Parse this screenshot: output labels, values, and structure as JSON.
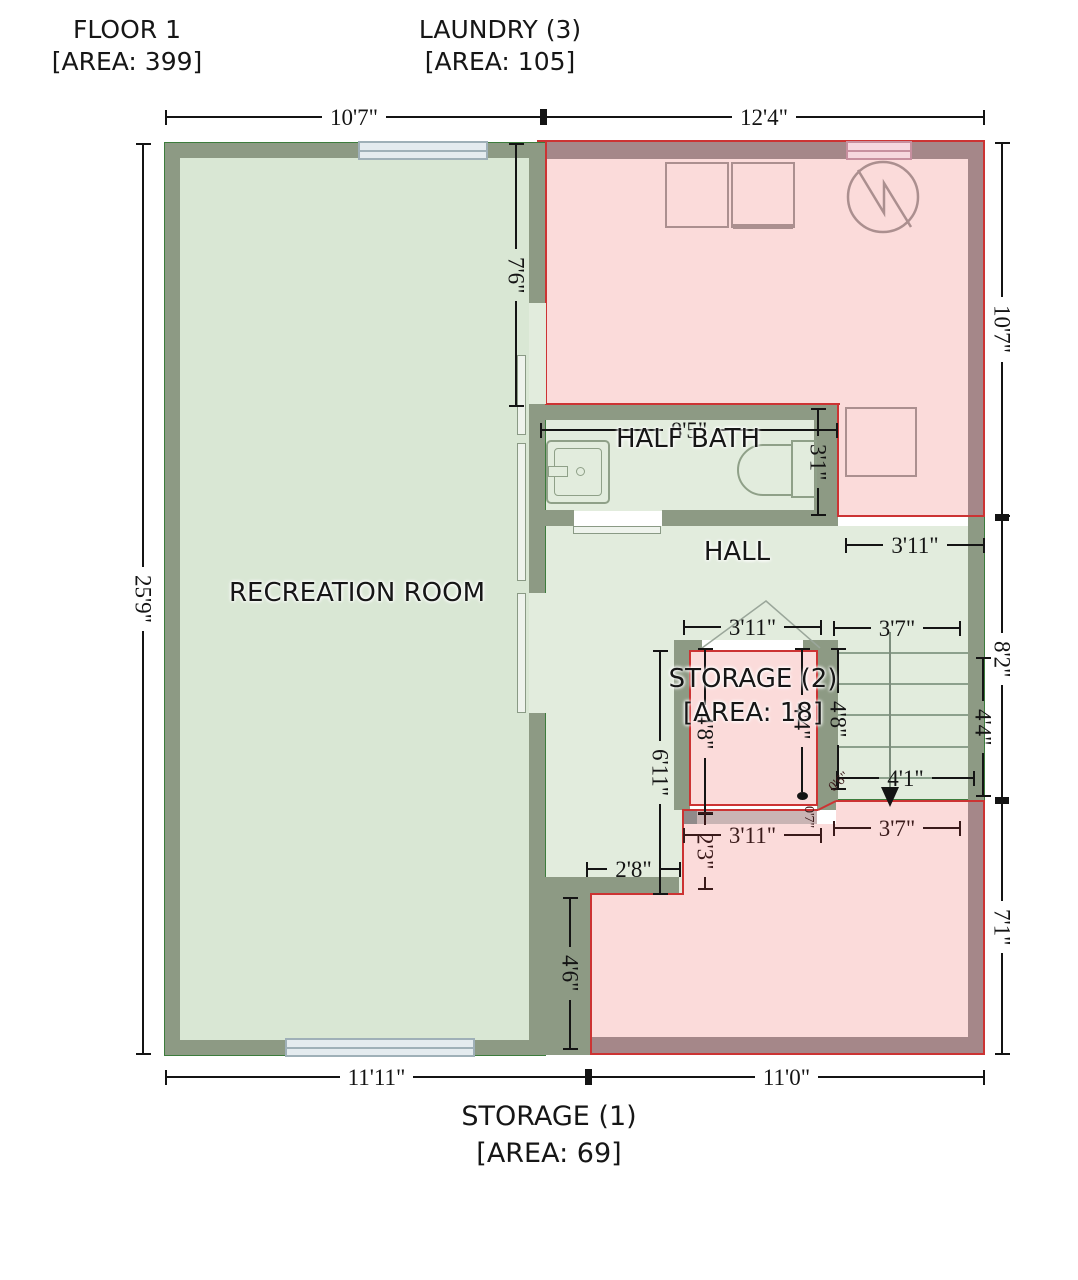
{
  "header": {
    "floor_label": "FLOOR 1",
    "floor_area": "[AREA: 399]",
    "laundry_label": "LAUNDRY (3)",
    "laundry_area": "[AREA: 105]"
  },
  "rooms": {
    "recreation": "RECREATION ROOM",
    "half_bath": "HALF BATH",
    "hall": "HALL",
    "storage2": "STORAGE (2)",
    "storage2_area": "[AREA: 18]",
    "storage1": "STORAGE (1)",
    "storage1_area": "[AREA: 69]"
  },
  "dims": {
    "top_left": "10'7\"",
    "top_right": "12'4\"",
    "left_side": "25'9\"",
    "right_top": "10'7\"",
    "right_mid": "8'2\"",
    "right_inner": "4'4\"",
    "right_bottom": "7'1\"",
    "bottom_left": "11'11\"",
    "bottom_right": "11'0\"",
    "laundry_wall": "7'6\"",
    "bath_width": "8'5\"",
    "bath_depth": "3'1\"",
    "hall_right": "3'11\"",
    "storage2_top": "3'11\"",
    "storage2_left": "4'8\"",
    "storage2_right": "4'4\"",
    "storage2_bottom": "3'11\"",
    "stairs_top": "3'7\"",
    "stairs_left": "4'8\"",
    "stairs_run": "4'1\"",
    "hall_column": "6'11\"",
    "storage1_top": "3'7\"",
    "wall_seg": "2'3\"",
    "hall_bottom": "2'8\"",
    "rec_corner": "4'6\"",
    "tiny_a": "0'6\"",
    "tiny_b": "0'7\""
  },
  "colors": {
    "green-wall": "#8d9a84",
    "green-fill": "#d9e7d4",
    "green-fill-light": "#e2ecdd",
    "green-outline": "#3c7c3c",
    "pink-wall": "#a58789",
    "pink-fill": "#fbdbda",
    "red-outline": "#cc3333",
    "fixture-mauve": "#ab8f8f",
    "fixture-green": "#8fa088",
    "window-blue": "#e4ebef",
    "dim": "#141414"
  }
}
